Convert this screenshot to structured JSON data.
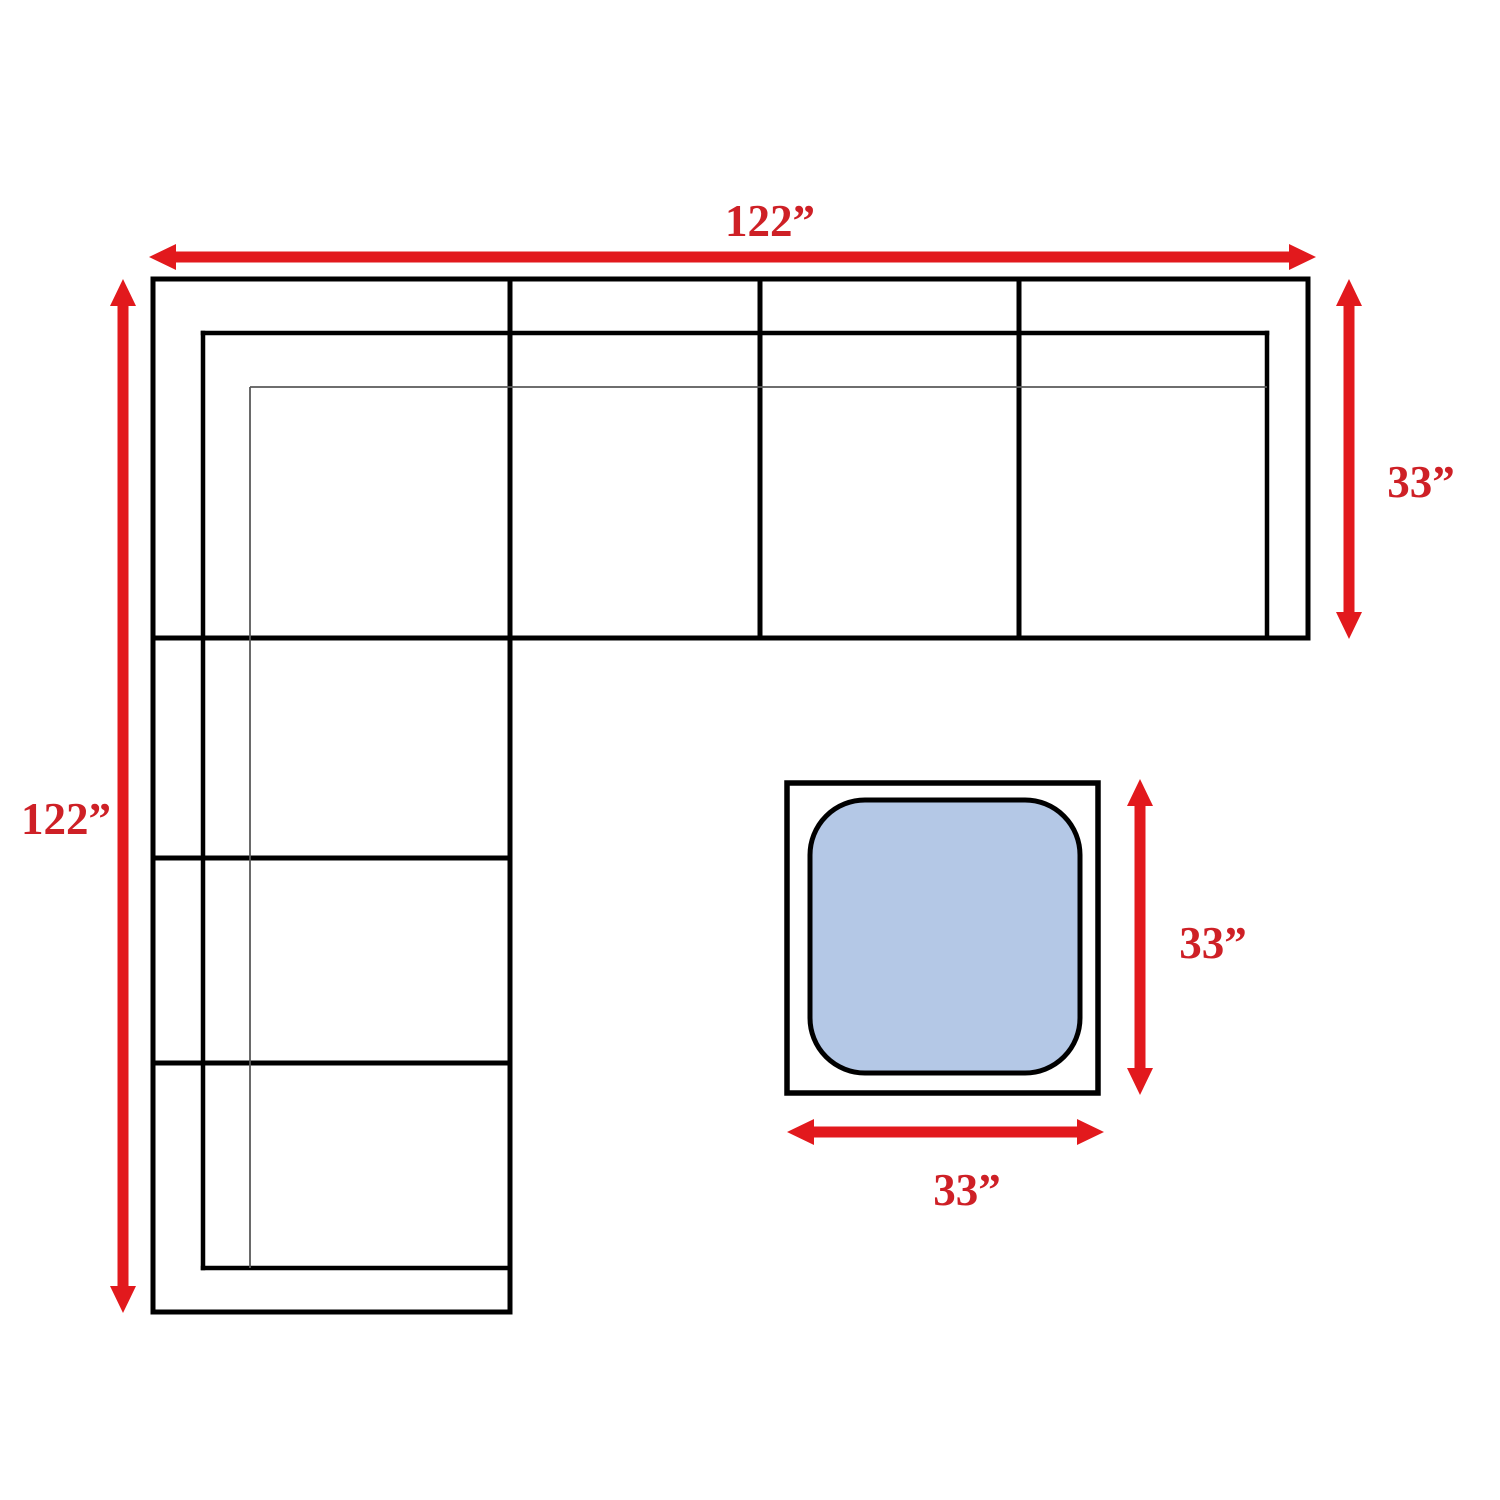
{
  "diagram": {
    "labels": {
      "sofa_width": "122”",
      "sofa_length": "122”",
      "sofa_depth": "33”",
      "ottoman_depth": "33”",
      "ottoman_width": "33”"
    },
    "dimensions_inches": {
      "sofa_width": 122,
      "sofa_length": 122,
      "sofa_section_depth": 33,
      "ottoman_width": 33,
      "ottoman_depth": 33
    },
    "colors": {
      "arrow": "#e2191d",
      "label": "#ce2026",
      "outline": "#000000",
      "detail_line": "#5a5a5a",
      "ottoman_fill": "#b4c8e6",
      "background": "#ffffff"
    }
  }
}
